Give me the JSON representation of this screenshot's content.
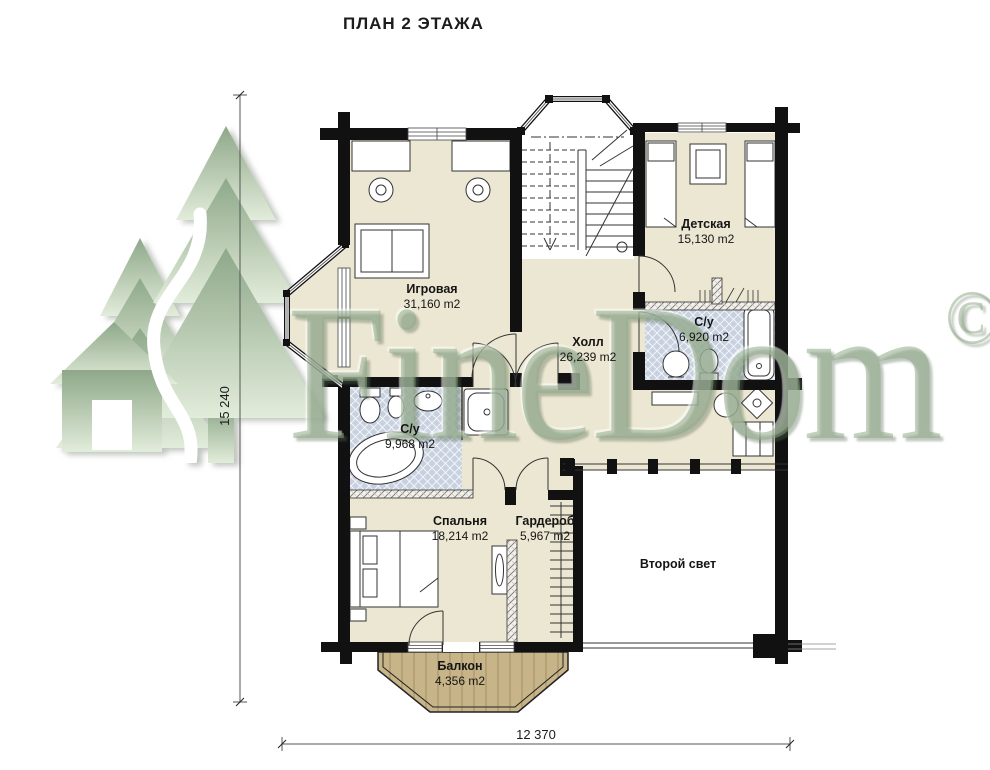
{
  "title": "ПЛАН 2 ЭТАЖА",
  "watermark": {
    "brand": "FineDom",
    "copyright_symbol": "©"
  },
  "dimensions": {
    "vertical": "15 240",
    "horizontal": "12 370"
  },
  "rooms": {
    "playroom": {
      "name": "Игровая",
      "area": "31,160 m2"
    },
    "hall": {
      "name": "Холл",
      "area": "26,239 m2"
    },
    "children": {
      "name": "Детская",
      "area": "15,130 m2"
    },
    "bathroom_small": {
      "name": "С/у",
      "area": "6,920 m2"
    },
    "bathroom_large": {
      "name": "С/у",
      "area": "9,968 m2"
    },
    "bedroom": {
      "name": "Спальня",
      "area": "18,214 m2"
    },
    "wardrobe": {
      "name": "Гардероб",
      "area": "5,967 m2"
    },
    "void": {
      "name": "Второй свет",
      "area": ""
    },
    "balcony": {
      "name": "Балкон",
      "area": "4,356 m2"
    }
  },
  "colors": {
    "floor": "#ece7d2",
    "bathroom_floor": "#c7d1e0",
    "balcony_floor": "#c7b489",
    "wall": "#111111",
    "watermark_green": "#8ea889"
  }
}
